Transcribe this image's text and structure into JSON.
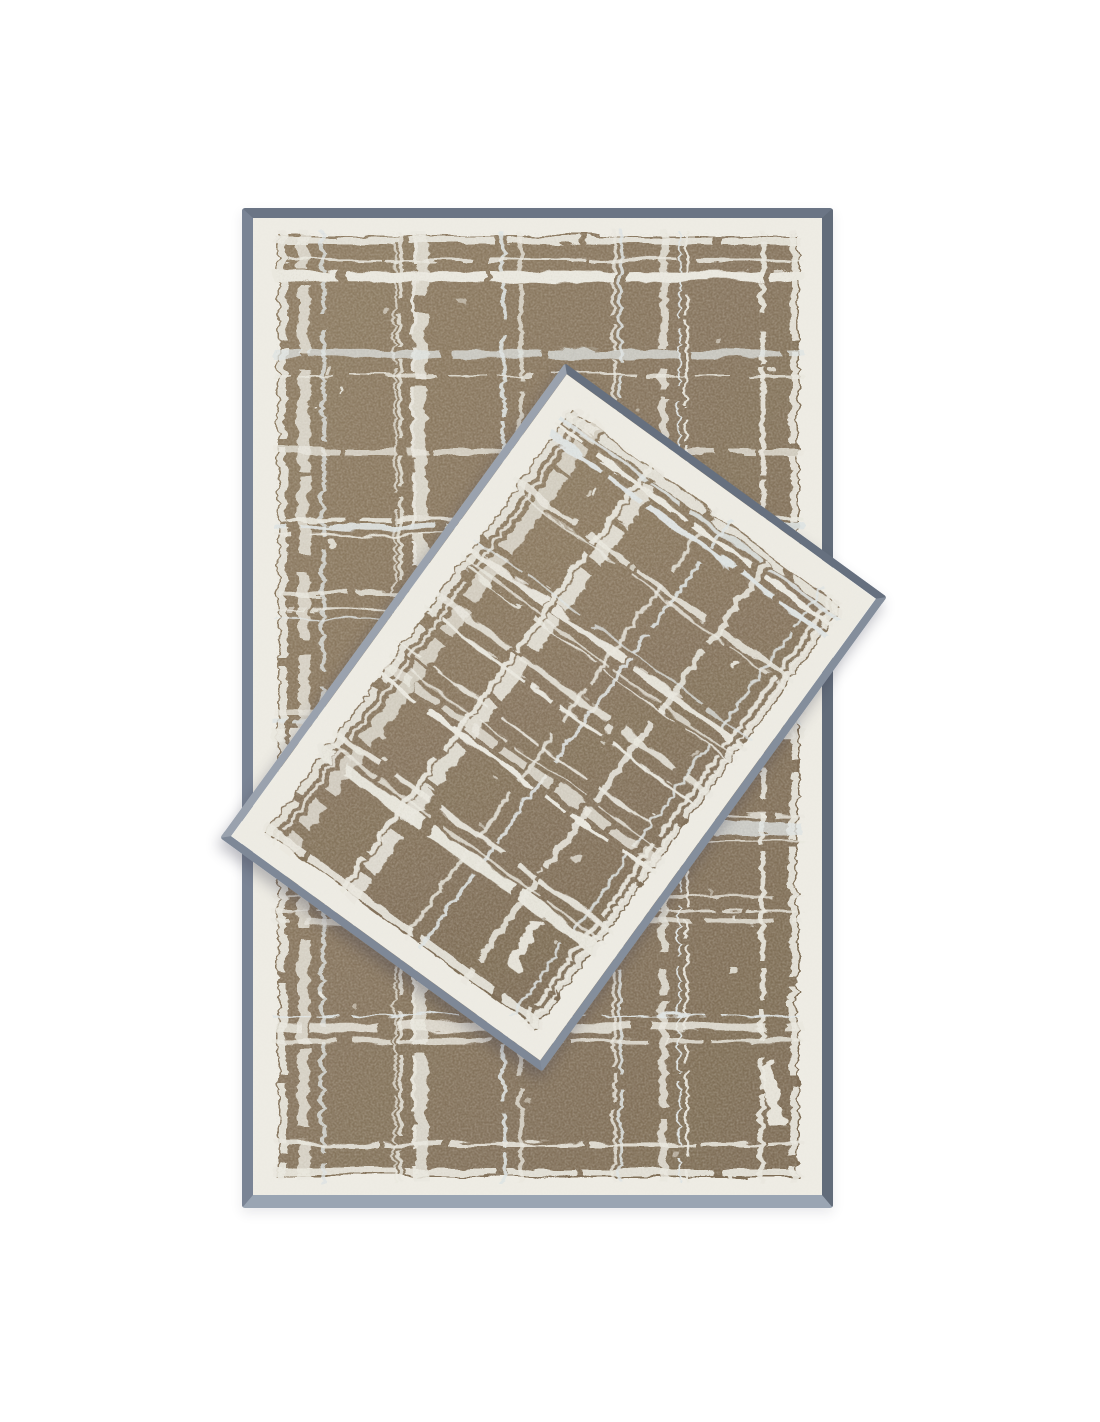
{
  "scene": {
    "type": "product-photo",
    "description": "Two-piece terry towel set with a distressed white crosshatch plaid pattern on a taupe-brown ground, ivory borders and slate-gray woven trim, photographed flat on a white background; the smaller guest towel lies diagonally on top of the larger bath towel",
    "brand_mark": "greyhound-silhouette"
  },
  "products": {
    "large_towel": {
      "label": "Bath towel",
      "pattern": "distressed check",
      "orientation_deg": 0
    },
    "small_towel": {
      "label": "Guest towel",
      "pattern": "distressed check",
      "orientation_deg": 36
    }
  },
  "colors": {
    "background": "#ffffff",
    "towel_base_brown": "#8f7d64",
    "towel_base_brown_dark": "#7e6d57",
    "pattern_line_white": "#eae8df",
    "pattern_line_cool": "#dfe4e3",
    "border_ivory": "#edebe3",
    "large_trim": {
      "top": "#6b7585",
      "right": "#626c7a",
      "bottom": "#9aa5b3",
      "left": "#7a8495"
    },
    "small_trim": {
      "top": "#66707f",
      "right": "#848e9c",
      "bottom": "#7e8897",
      "left": "#9aa2ae"
    },
    "shadow": "rgba(60,62,78,0.33)"
  }
}
